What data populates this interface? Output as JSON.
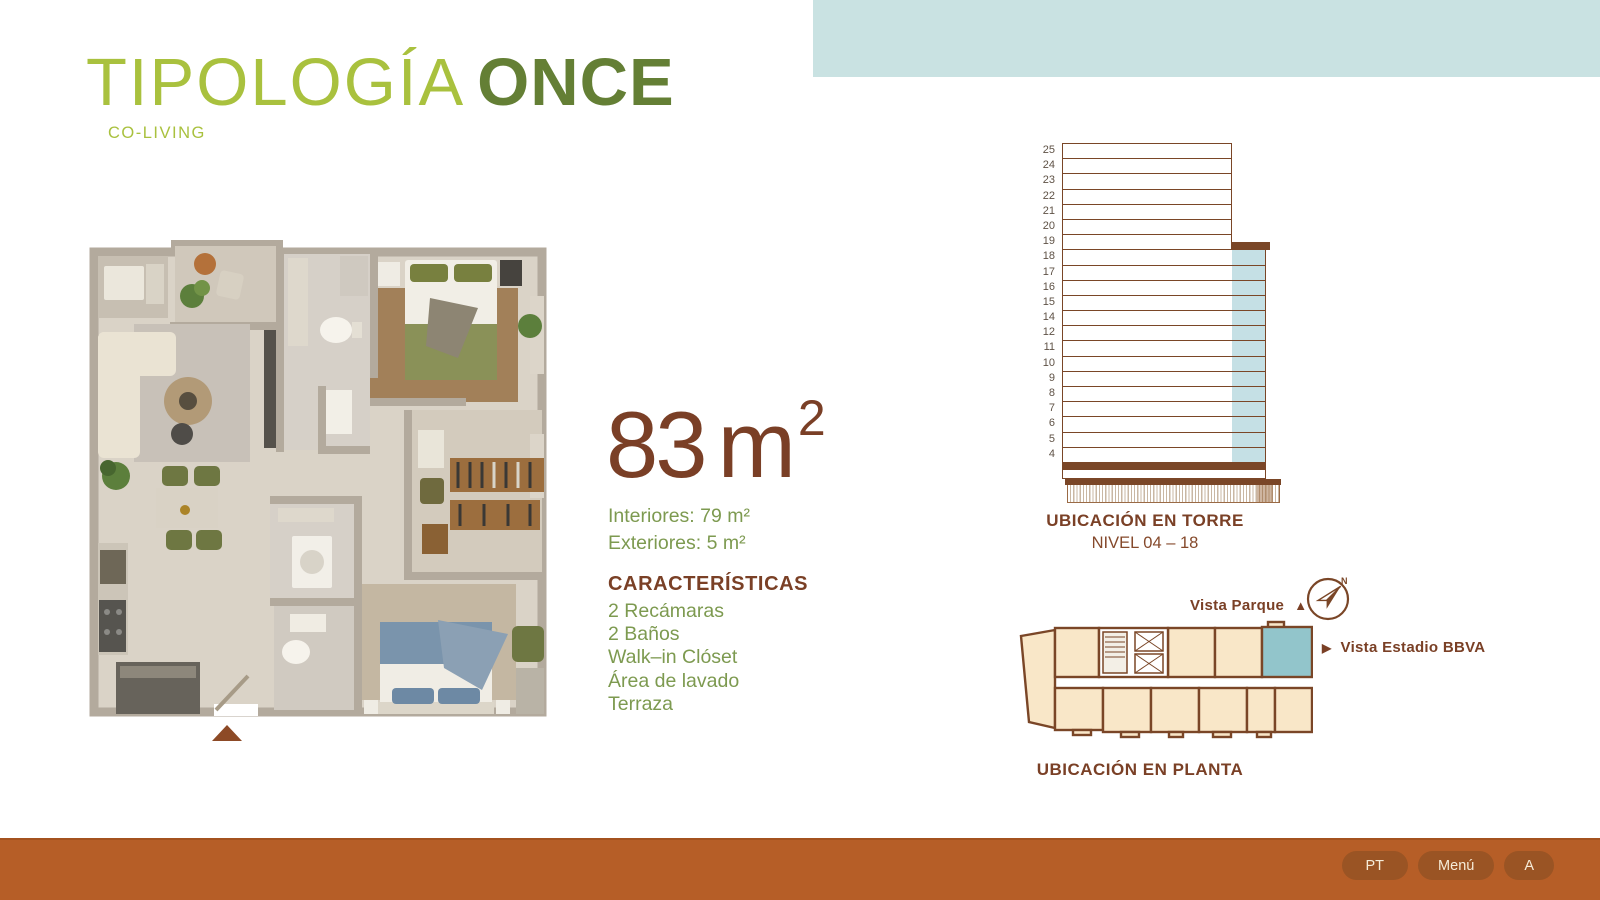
{
  "header": {
    "title_light": "TIPOLOGÍA",
    "title_bold": "ONCE",
    "subtitle": "CO-LIVING"
  },
  "area": {
    "value": "83",
    "unit": "m",
    "exp": "2",
    "interiors": "Interiores: 79 m²",
    "exteriors": "Exteriores: 5 m²"
  },
  "features": {
    "title": "CARACTERÍSTICAS",
    "items": [
      "2 Recámaras",
      "2 Baños",
      "Walk–in Clóset",
      "Área de lavado",
      "Terraza"
    ]
  },
  "tower": {
    "caption": "UBICACIÓN EN TORRE",
    "level_range": "NIVEL 04 – 18",
    "floors": [
      25,
      24,
      23,
      22,
      21,
      20,
      19,
      18,
      17,
      16,
      15,
      14,
      12,
      11,
      10,
      9,
      8,
      7,
      6,
      5,
      4
    ],
    "setback_floor": 19,
    "highlight_floors": "04-18"
  },
  "plate": {
    "caption": "UBICACIÓN EN PLANTA",
    "view_top": "Vista Parque",
    "view_right": "Vista Estadio BBVA",
    "compass": "N"
  },
  "footer": {
    "buttons": [
      "PT",
      "Menú",
      "A"
    ]
  },
  "colors": {
    "accent_green_light": "#a9c13e",
    "accent_green_dark": "#647f35",
    "brown_heading": "#7a4026",
    "text_green": "#7d9a50",
    "teal_band": "#c9e2e2",
    "tower_highlight": "#c5e0e5",
    "tower_outline": "#7a4627",
    "plate_unit_fill": "#f9e7c8",
    "plate_highlight": "#92c5cb",
    "footer_bar": "#b65e27",
    "footer_button": "#9a5424"
  }
}
